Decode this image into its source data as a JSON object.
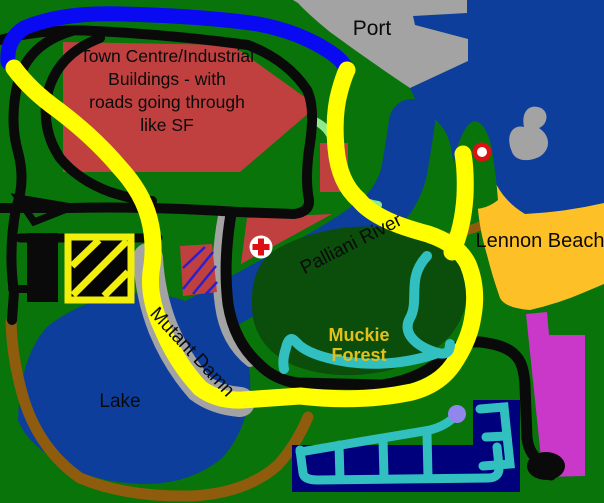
{
  "title": "Hand-drawn town plan (paint style map)",
  "labels": {
    "port": "Port",
    "town": {
      "lines": [
        "Town Centre/Industrial",
        "Buildings - with",
        "roads going through",
        "like SF"
      ]
    },
    "river": "Palliani River",
    "beach": "Lennon Beach",
    "forest": {
      "lines": [
        "Muckie",
        "Forest"
      ]
    },
    "dam": "Mutant Damn",
    "lake": "Lake"
  },
  "palette": {
    "land": "#097409",
    "deep_forest": "#0b4d0b",
    "water": "#0d3e9c",
    "marina_navy": "#00007d",
    "road_yellow": "#ffff00",
    "road_black": "#0a0a0a",
    "road_blue": "#0909f2",
    "road_brown": "#8f5c0e",
    "structure_gray": "#a3a3a3",
    "beach_orange": "#fdc127",
    "building_red": "#c04040",
    "magenta_zone": "#c938c9",
    "stream_cyan": "#32bfbf",
    "path_lightgreen": "#8fe98f",
    "stripe_violet": "#2a20d0",
    "hazard_yellow": "#f2ef0a",
    "marker_red": "#dd1111",
    "marker_white": "#ffffff",
    "dot_lavender": "#9186ec",
    "label_black": "#0a0a0a",
    "forest_label_gold": "#e2c01b"
  }
}
